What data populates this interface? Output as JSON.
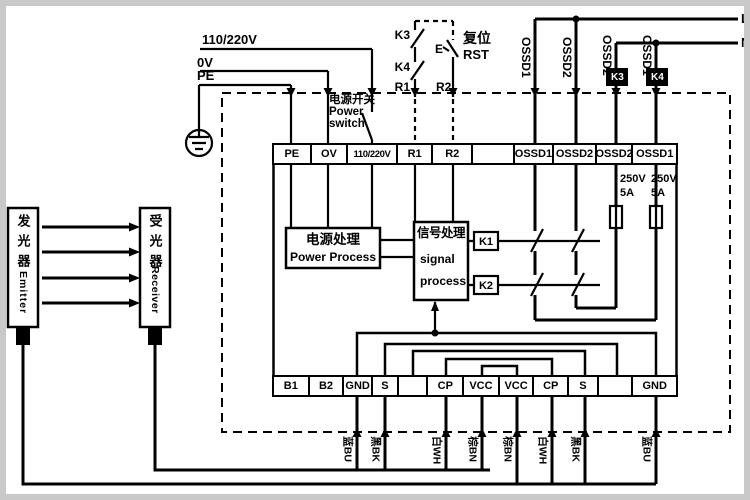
{
  "rails": {
    "v110": "110/220V",
    "v0": "0V",
    "pe": "PE"
  },
  "mains": {
    "l": "L",
    "n": "N"
  },
  "reset_circuit": {
    "k3": "K3",
    "k4": "K4",
    "r1": "R1",
    "r2": "R2",
    "button": "E",
    "reset_cn": "复位",
    "reset_en": "RST"
  },
  "power_switch": {
    "cn": "电源开关",
    "en_line1": "Power",
    "en_line2": "switch"
  },
  "relay_coils": {
    "k3": "K3",
    "k4": "K4"
  },
  "ossd_lines": [
    "OSSD1",
    "OSSD2",
    "OSSD2",
    "OSSD1"
  ],
  "top_terminals": [
    "PE",
    "OV",
    "110/220V",
    "R1",
    "R2",
    "",
    "OSSD1",
    "OSSD2",
    "OSSD2",
    "OSSD1"
  ],
  "bottom_terminals": [
    "B1",
    "B2",
    "GND",
    "S",
    "",
    "CP",
    "VCC",
    "VCC",
    "CP",
    "S",
    "",
    "GND"
  ],
  "processing": {
    "power_cn": "电源处理",
    "power_en": "Power Process",
    "signal_cn": "信号处理",
    "signal_en_line1": "signal",
    "signal_en_line2": "process",
    "k1": "K1",
    "k2": "K2"
  },
  "fuses": {
    "voltage": "250V",
    "current": "5A"
  },
  "wire_colors": [
    "蓝BU",
    "黑BK",
    "白WH",
    "棕BN",
    "棕BN",
    "白WH",
    "黑BK",
    "蓝BU"
  ],
  "devices": {
    "emitter_cn": "发光器",
    "emitter_en": "Emitter",
    "receiver_cn": "受光器",
    "receiver_en": "Receiver"
  },
  "colors": {
    "line": "#000000",
    "frame": "#c9c9c9"
  }
}
